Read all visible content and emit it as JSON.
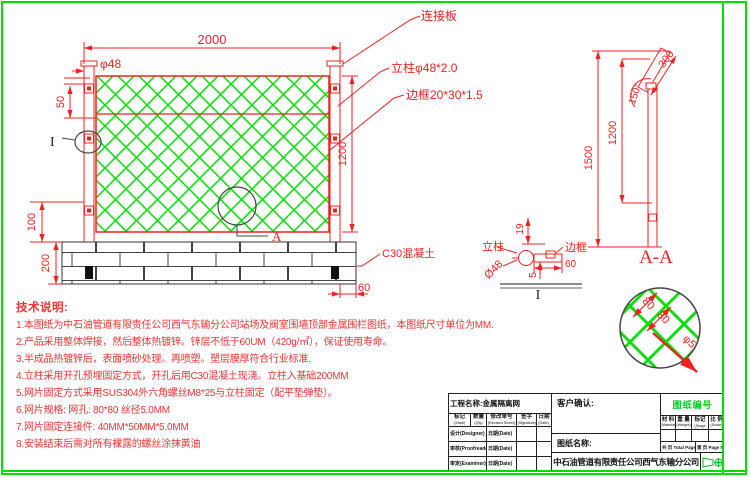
{
  "colors": {
    "red": "#f22020",
    "green": "#00df00",
    "black": "#222222",
    "drawing_no_green": "#00cc22"
  },
  "front_view": {
    "dim_2000": "2000",
    "dim_phi48": "φ48",
    "dim_50": "50",
    "dim_100": "100",
    "dim_200": "200",
    "dim_1200": "1200",
    "dim_60": "60",
    "label_connector_plate": "连接板",
    "label_post": "立柱φ48*2.0",
    "label_frame": "边框20*30*1.5",
    "label_concrete": "C30混凝土",
    "detail_a_label": "A",
    "detail_i_label": "I"
  },
  "side_view": {
    "dim_1500": "1500",
    "dim_1200": "1200",
    "dim_300": "300",
    "dim_angle": "150°",
    "section_label": "A-A"
  },
  "detail_i": {
    "label_post": "立柱",
    "dim_diameter": "Ø48",
    "dim_19": "19",
    "label_frame": "边框",
    "dim_60": "60",
    "dim_5": "5",
    "label": "I"
  },
  "detail_mesh": {
    "dim_80a": "80",
    "dim_80b": "80",
    "dim_phi5": "φ5"
  },
  "notes": {
    "title": "技术说明:",
    "lines": [
      "1.本图纸为中石油管道有限责任公司西气东输分公司站场及阀室围墙顶部金属围栏图纸，本图纸尺寸单位为MM.",
      "2.产品采用整体焊接，然后整体热镀锌。锌层不低于60UM（420g/㎡），保证使用寿命。",
      "3.半成品热镀锌后，表面喷砂处理。再喷塑。塑层膜厚符合行业标准.",
      "4.立柱采用开孔预埋固定方式，开孔后用C30混凝土现浇。立柱入基础200MM",
      "5.网片固定方式采用SUS304外六角螺丝M8*25与立柱固定（配平垫弹垫）。",
      "6.网片规格: 网孔: 80*80  丝径5.0MM",
      "7.网片固定连接件: 40MM*50MM*5.0MM",
      "8.安装结束后需对所有裸露的螺丝涂抹黄油"
    ]
  },
  "title_block": {
    "project_label": "工程名称:金属隔离网",
    "customer_label": "客户确认:",
    "drawing_no_label": "图纸编号",
    "drawing_name_label": "图纸名称:",
    "company": "中石油管道有限责任公司西气东输分公司",
    "rev_headers": [
      {
        "zh": "标记",
        "en": "(Mark)"
      },
      {
        "zh": "数量",
        "en": "(Qty)"
      },
      {
        "zh": "修改单号",
        "en": "(Revised Sheet)"
      },
      {
        "zh": "签字",
        "en": "(Signature)"
      },
      {
        "zh": "日期",
        "en": "(Date)"
      }
    ],
    "sign_rows": [
      {
        "role": "设计(Designer)",
        "date": "日期(Date)"
      },
      {
        "role": "审核(Proofreader)",
        "date": "日期(Date)"
      },
      {
        "role": "审定(Examiner)",
        "date": "日期(Date)"
      }
    ],
    "spec_headers": [
      {
        "zh": "材 料",
        "en": "(Material)"
      },
      {
        "zh": "重 量",
        "en": "(Weight)"
      },
      {
        "zh": "阶段标记",
        "en": "(Stage Mark)"
      },
      {
        "zh": "比 例",
        "en": "(Scale)"
      }
    ],
    "pages_total": "共 页 Total Pages",
    "page_no": "第 页 Page No."
  }
}
